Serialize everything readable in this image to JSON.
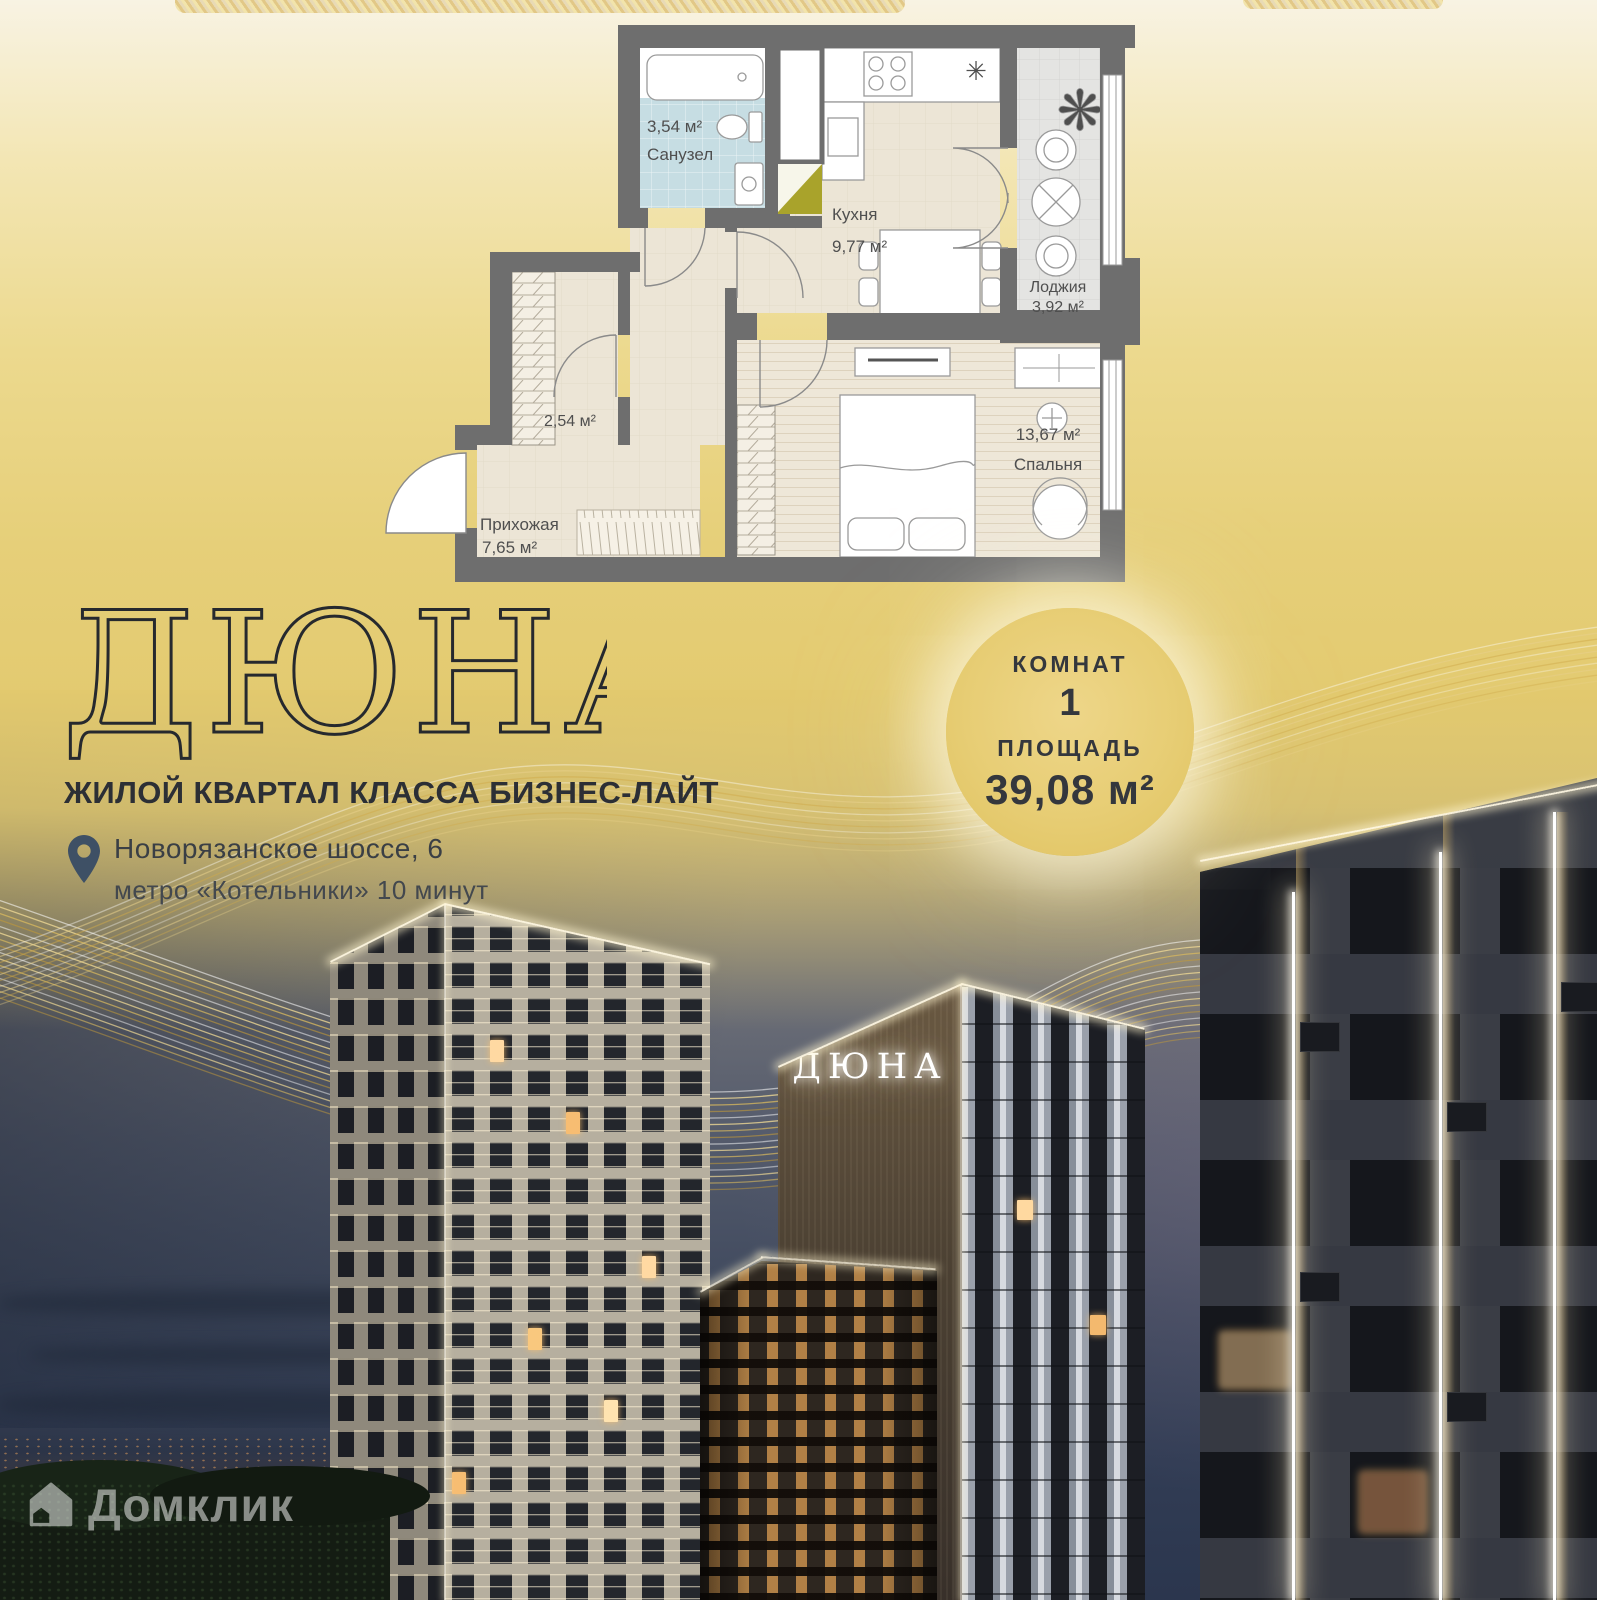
{
  "colors": {
    "gold": "#e2c96e",
    "cream": "#f8f3e3",
    "ink": "#2b2e34",
    "wall": "#6e6e6e",
    "label": "#4f4f4f",
    "pin": "#3e5065",
    "olive": "#a9a32b",
    "bath-floor": "#c6dde3",
    "room-floor": "#ece5d6",
    "loggia-floor": "#e4e4e2",
    "sign-glow": "#ffffff"
  },
  "brand": {
    "title": "ДЮНА",
    "subtitle": "ЖИЛОЙ КВАРТАЛ КЛАССА БИЗНЕС-ЛАЙТ"
  },
  "location": {
    "address": "Новорязанское шоссе, 6",
    "metro": "метро «Котельники» 10 минут"
  },
  "badge": {
    "rooms_label": "КОМНАТ",
    "rooms_value": "1",
    "area_label": "ПЛОЩАДЬ",
    "area_value": "39,08 м²"
  },
  "floorplan": {
    "bath": {
      "area": "3,54 м²",
      "name": "Санузел"
    },
    "kitchen": {
      "name": "Кухня",
      "area": "9,77 м²"
    },
    "loggia": {
      "name": "Лоджия",
      "area": "3,92 м²"
    },
    "wardrobe": {
      "area": "2,54 м²"
    },
    "hall": {
      "name": "Прихожая",
      "area": "7,65 м²"
    },
    "bedroom": {
      "area": "13,67 м²",
      "name": "Спальня"
    }
  },
  "building": {
    "sign": "ДЮНА"
  },
  "watermark": {
    "text": "Домклик"
  }
}
